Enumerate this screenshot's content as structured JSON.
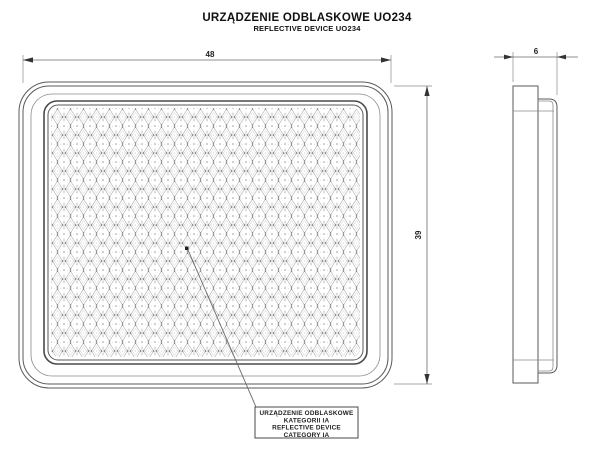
{
  "title": {
    "main": "URZĄDZENIE ODBLASKOWE UO234",
    "sub": "REFLECTIVE DEVICE UO234"
  },
  "views": {
    "front": {
      "label": "front-view-of-reflector",
      "dimensions": {
        "width": "48",
        "height": "39"
      }
    },
    "side": {
      "label": "side-view-of-reflector",
      "dimensions": {
        "depth": "6"
      }
    }
  },
  "callout": {
    "line1": "URZĄDZENIE ODBLASKOWE",
    "line2": "KATEGORII IA",
    "line3": "REFLECTIVE DEVICE",
    "line4": "CATEGORY IA"
  },
  "colors": {
    "background": "#ffffff",
    "outline": "#5a5a5a",
    "dimension": "#6a6a6a",
    "pattern_primary": "#adadad",
    "pattern_secondary": "#cfcfcf",
    "pattern_dots": "#7a7a7a",
    "text": "#111111"
  }
}
